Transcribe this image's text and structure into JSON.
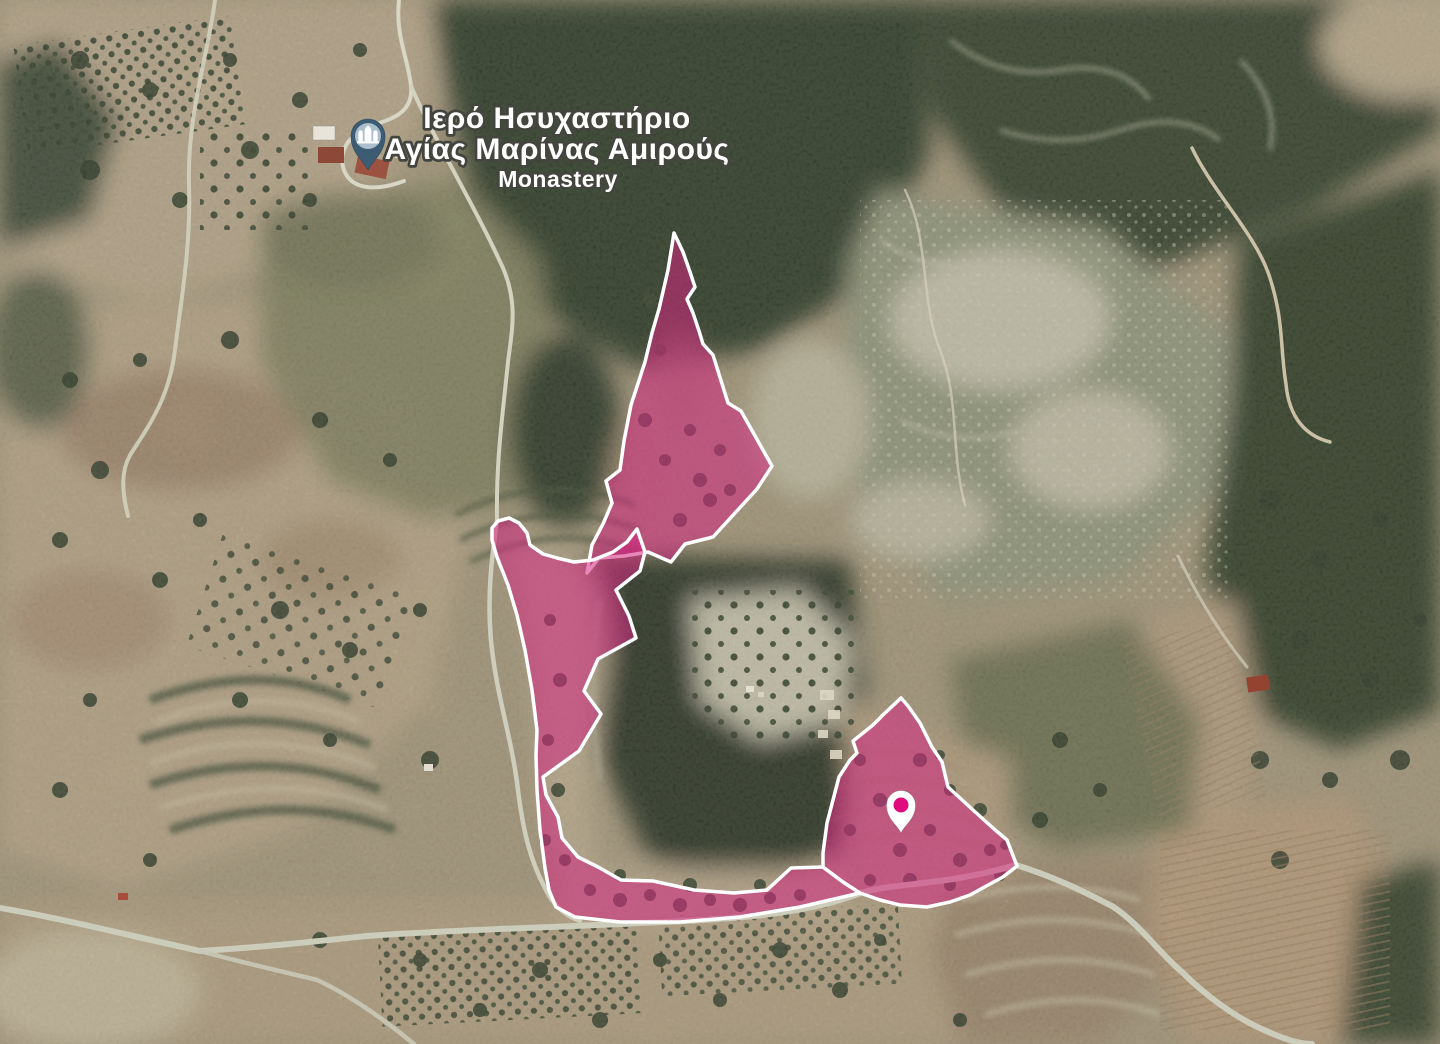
{
  "map": {
    "view": "satellite",
    "poi": {
      "title_line1": "Ιερό Ησυχαστήριο",
      "title_line2": "Αγίας Μαρίνας Αμιρούς",
      "subtitle": "Monastery",
      "pin": {
        "icon": "monastery-pin",
        "color": "#3d5c73",
        "inner_color": "#a9bfcd",
        "glyph_color": "#ffffff",
        "tip_x": 368,
        "tip_y": 170
      }
    },
    "parcels": {
      "fill_color": "#d4267f",
      "fill_opacity": "0.55",
      "outline_color": "#ffffff",
      "north": {
        "points": [
          [
            674,
            233
          ],
          [
            683,
            252
          ],
          [
            690,
            272
          ],
          [
            695,
            287
          ],
          [
            687,
            299
          ],
          [
            693,
            313
          ],
          [
            699,
            331
          ],
          [
            703,
            344
          ],
          [
            713,
            355
          ],
          [
            728,
            403
          ],
          [
            741,
            411
          ],
          [
            772,
            466
          ],
          [
            757,
            489
          ],
          [
            713,
            537
          ],
          [
            685,
            544
          ],
          [
            671,
            562
          ],
          [
            648,
            552
          ],
          [
            624,
            556
          ],
          [
            599,
            558
          ],
          [
            587,
            573
          ],
          [
            592,
            545
          ],
          [
            603,
            524
          ],
          [
            612,
            503
          ],
          [
            606,
            481
          ],
          [
            620,
            470
          ],
          [
            624,
            441
          ],
          [
            631,
            405
          ],
          [
            645,
            362
          ],
          [
            652,
            333
          ],
          [
            659,
            309
          ],
          [
            668,
            270
          ]
        ]
      },
      "west": {
        "points": [
          [
            498,
            521
          ],
          [
            509,
            518
          ],
          [
            519,
            523
          ],
          [
            527,
            533
          ],
          [
            530,
            545
          ],
          [
            543,
            554
          ],
          [
            557,
            558
          ],
          [
            574,
            562
          ],
          [
            593,
            560
          ],
          [
            613,
            552
          ],
          [
            627,
            542
          ],
          [
            637,
            529
          ],
          [
            645,
            552
          ],
          [
            640,
            571
          ],
          [
            616,
            590
          ],
          [
            629,
            616
          ],
          [
            636,
            638
          ],
          [
            598,
            659
          ],
          [
            584,
            691
          ],
          [
            601,
            714
          ],
          [
            579,
            751
          ],
          [
            543,
            777
          ],
          [
            546,
            795
          ],
          [
            558,
            817
          ],
          [
            562,
            838
          ],
          [
            578,
            857
          ],
          [
            598,
            867
          ],
          [
            621,
            880
          ],
          [
            653,
            881
          ],
          [
            694,
            890
          ],
          [
            734,
            893
          ],
          [
            767,
            890
          ],
          [
            791,
            868
          ],
          [
            823,
            867
          ],
          [
            843,
            882
          ],
          [
            860,
            893
          ],
          [
            800,
            907
          ],
          [
            740,
            917
          ],
          [
            680,
            922
          ],
          [
            620,
            922
          ],
          [
            575,
            917
          ],
          [
            556,
            907
          ],
          [
            549,
            890
          ],
          [
            545,
            868
          ],
          [
            540,
            830
          ],
          [
            537,
            790
          ],
          [
            536,
            755
          ],
          [
            537,
            730
          ],
          [
            532,
            690
          ],
          [
            525,
            650
          ],
          [
            517,
            615
          ],
          [
            508,
            585
          ],
          [
            497,
            557
          ],
          [
            492,
            540
          ],
          [
            492,
            528
          ]
        ]
      },
      "southeast": {
        "points": [
          [
            901,
            698
          ],
          [
            908,
            706
          ],
          [
            920,
            723
          ],
          [
            932,
            747
          ],
          [
            942,
            762
          ],
          [
            948,
            787
          ],
          [
            973,
            810
          ],
          [
            993,
            828
          ],
          [
            1007,
            840
          ],
          [
            1017,
            866
          ],
          [
            1003,
            877
          ],
          [
            990,
            884
          ],
          [
            970,
            895
          ],
          [
            950,
            902
          ],
          [
            927,
            907
          ],
          [
            900,
            905
          ],
          [
            880,
            900
          ],
          [
            860,
            893
          ],
          [
            843,
            882
          ],
          [
            823,
            867
          ],
          [
            823,
            853
          ],
          [
            827,
            823
          ],
          [
            833,
            800
          ],
          [
            839,
            777
          ],
          [
            850,
            760
          ],
          [
            857,
            753
          ],
          [
            853,
            741
          ],
          [
            873,
            725
          ],
          [
            884,
            714
          ]
        ]
      }
    },
    "selected_marker": {
      "body_color": "#ffffff",
      "dot_color": "#e00b7f",
      "tip_x": 901,
      "tip_y": 833
    }
  }
}
